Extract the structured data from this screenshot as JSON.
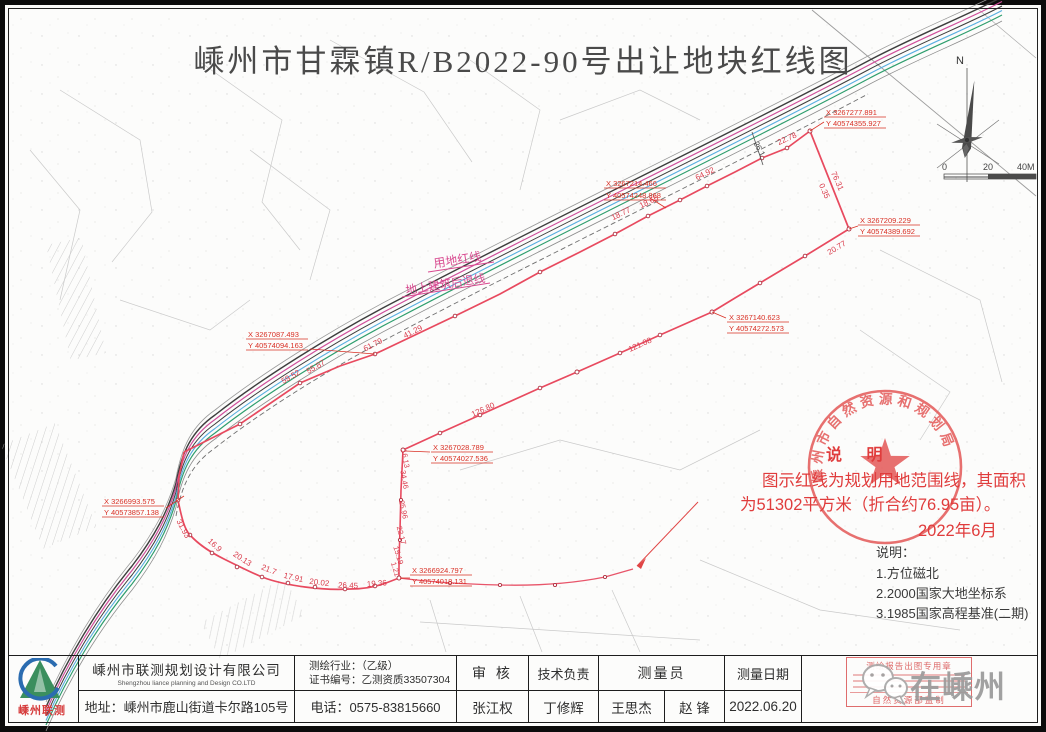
{
  "page": {
    "title": "嵊州市甘霖镇R/B2022-90号出让地块红线图"
  },
  "compass": {
    "north": "N"
  },
  "scalebar": {
    "zero": "0",
    "mid": "20",
    "end": "40M"
  },
  "map": {
    "legend_labels": {
      "parcel_line": "用地红线",
      "setback_line": "地上建筑后退线"
    },
    "coordinates": [
      {
        "x": "X 3267277.891",
        "y": "Y 40574355.927"
      },
      {
        "x": "X 3267209.229",
        "y": "Y 40574389.692"
      },
      {
        "x": "X 3267214.466",
        "y": "Y 40574248.868"
      },
      {
        "x": "X 3267140.623",
        "y": "Y 40574272.573"
      },
      {
        "x": "X 3267087.493",
        "y": "Y 40574094.163"
      },
      {
        "x": "X 3267028.789",
        "y": "Y 40574027.536"
      },
      {
        "x": "X 3266993.575",
        "y": "Y 40573857.138"
      },
      {
        "x": "X 3266924.797",
        "y": "Y 40574018.131"
      }
    ],
    "edge_lengths": [
      "22.78",
      "64.92",
      "18.65",
      "18.77",
      "76.31",
      "0.35",
      "20.77",
      "121.08",
      "126.80",
      "61.79",
      "55.87",
      "59.52",
      "41.29",
      "26.1"
    ],
    "arc_lengths": [
      "31.93",
      "16.9",
      "20.13",
      "21.7",
      "17.91",
      "20.02",
      "26.45",
      "19.36"
    ],
    "side_lengths": [
      "1.21",
      "15.19",
      "22.17",
      "25.96",
      "34.46",
      "16.13"
    ]
  },
  "seal": {
    "ring_text": "嵊州市自然资源和规划局"
  },
  "red_note": {
    "heading": "说  明",
    "line1": "图示红线为规划用地范围线，其面积",
    "line2": "为51302平方米（折合约76.95亩）。",
    "date": "2022年6月"
  },
  "notes": {
    "heading": "说明：",
    "item1": "1.方位磁北",
    "item2": "2.2000国家大地坐标系",
    "item3": "3.1985国家高程基准(二期)"
  },
  "titleblock": {
    "company_cn": "嵊州市联测规划设计有限公司",
    "company_en": "Shengzhou liance planning and Design CO.LTD",
    "address": "地址：嵊州市鹿山街道卡尔路105号",
    "industry": "测绘行业：（乙级）",
    "cert_no": "证书编号：乙测资质33507304",
    "phone": "电话：0575-83815660",
    "reviewer_label": "审 核",
    "reviewer": "张江权",
    "tech_label": "技术负责",
    "tech": "丁修辉",
    "surveyor_label": "测量员",
    "surveyor1": "王思杰",
    "surveyor2": "赵 锋",
    "date_label": "测量日期",
    "date": "2022.06.20",
    "logo_text": "嵊州联测"
  },
  "stamp": {
    "line_top": "测绘报告出图专用章",
    "line_bottom": "自然资源部监制"
  },
  "watermark": {
    "text": "在嵊州"
  }
}
